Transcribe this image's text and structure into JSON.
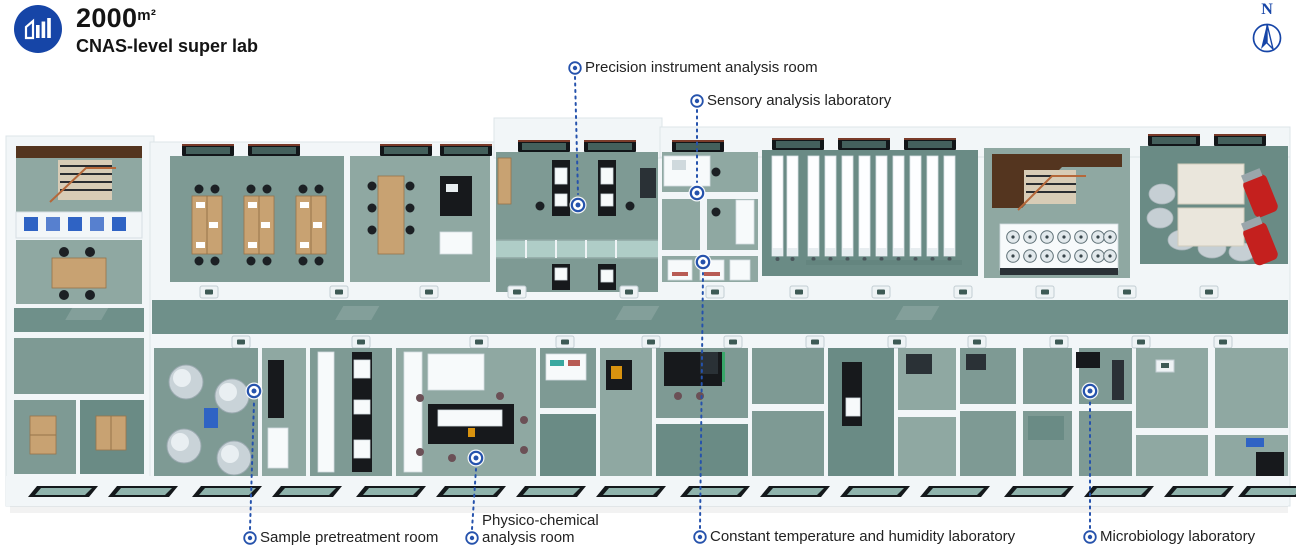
{
  "header": {
    "area_value": "2000",
    "area_unit": "m²",
    "subtitle": "CNAS-level super lab",
    "logo_icon": "building-bars-icon"
  },
  "compass": {
    "label": "N",
    "icon": "north-arrow-icon"
  },
  "palette": {
    "accent_blue": "#1645A7",
    "callout_blue": "#2552AC",
    "text_dark": "#222222",
    "floor_teal": "#7E9A94",
    "floor_teal_light": "#8FA8A2",
    "floor_teal_dark": "#6A8B85",
    "corridor_teal": "#6F908A",
    "wall_white": "#F2F6F8",
    "bench_black": "#17191C",
    "wood_tan": "#C8A272",
    "wood_dark_brown": "#54351F",
    "machine_red": "#C4201E",
    "tank_silver": "#C9D3D8",
    "glass_teal": "#B7D6D0"
  },
  "callouts": [
    {
      "id": "precision-instrument-analysis-room",
      "label": "Precision instrument analysis room",
      "lx": 575,
      "ly": 68,
      "ex": 578,
      "ey": 205
    },
    {
      "id": "sensory-analysis-laboratory",
      "label": "Sensory analysis laboratory",
      "lx": 697,
      "ly": 101,
      "ex": 697,
      "ey": 193
    },
    {
      "id": "sample-pretreatment-room",
      "label": "Sample pretreatment room",
      "lx": 250,
      "ly": 538,
      "ex": 254,
      "ey": 391
    },
    {
      "id": "physico-chemical-analysis-room",
      "label": "Physico-chemical analysis room",
      "label_lines": [
        "Physico-chemical",
        "analysis room"
      ],
      "lx": 472,
      "ly": 538,
      "ex": 476,
      "ey": 458
    },
    {
      "id": "constant-temperature-and-humidity-laboratory",
      "label": "Constant temperature and humidity laboratory",
      "lx": 700,
      "ly": 537,
      "ex": 703,
      "ey": 262
    },
    {
      "id": "microbiology-laboratory",
      "label": "Microbiology laboratory",
      "lx": 1090,
      "ly": 537,
      "ex": 1090,
      "ey": 391
    }
  ]
}
